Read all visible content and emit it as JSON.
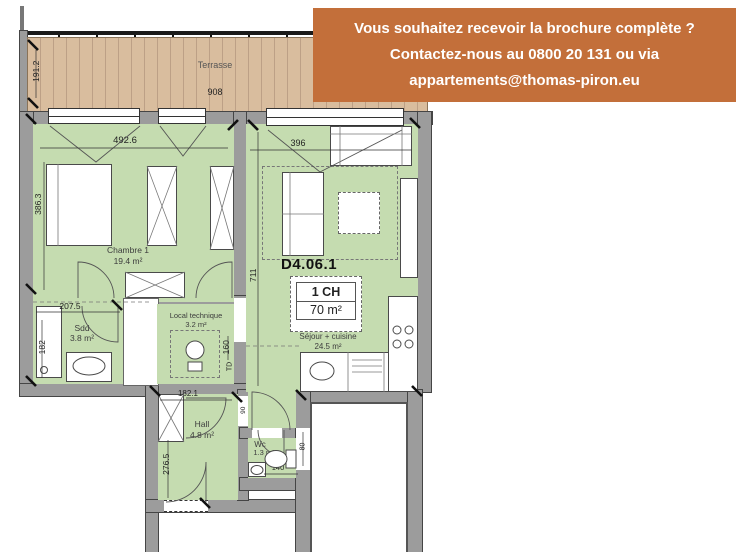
{
  "banner": {
    "line1": "Vous souhaitez recevoir la brochure complète ?",
    "line2": "Contactez-nous au 0800 20 131 ou via",
    "line3": "appartements@thomas-piron.eu"
  },
  "terrace": {
    "label": "Terrasse",
    "width": "908",
    "depth": "191.2"
  },
  "unit": {
    "code": "D4.06.1",
    "type": "1 CH",
    "area": "70 m²"
  },
  "rooms": {
    "chambre": {
      "name": "Chambre 1",
      "area": "19.4 m²"
    },
    "sejour": {
      "name": "Séjour + cuisine",
      "area": "24.5 m²"
    },
    "sdd": {
      "name": "Sdd",
      "area": "3.8 m²"
    },
    "local": {
      "name": "Local technique",
      "area": "3.2 m²"
    },
    "hall": {
      "name": "Hall",
      "area": "4.8 m²"
    },
    "wc": {
      "name": "Wc",
      "area": "1.3 m²"
    }
  },
  "dimensions": {
    "chambre_w": "492.6",
    "chambre_h": "386.3",
    "sejour_w": "396",
    "sejour_h": "711",
    "sdd_w": "207.5",
    "sdd_h": "182",
    "local_h": "160",
    "td": "TD",
    "hall_w": "182.1",
    "hall_h": "276.5",
    "wc_w": "140",
    "lobby": "90",
    "shaft": "80"
  },
  "colors": {
    "banner_bg": "#c36f3a",
    "room_green": "#c5dcb0",
    "terrace_tan": "#d9bd9e",
    "wall_gray": "#9c9c9c"
  }
}
